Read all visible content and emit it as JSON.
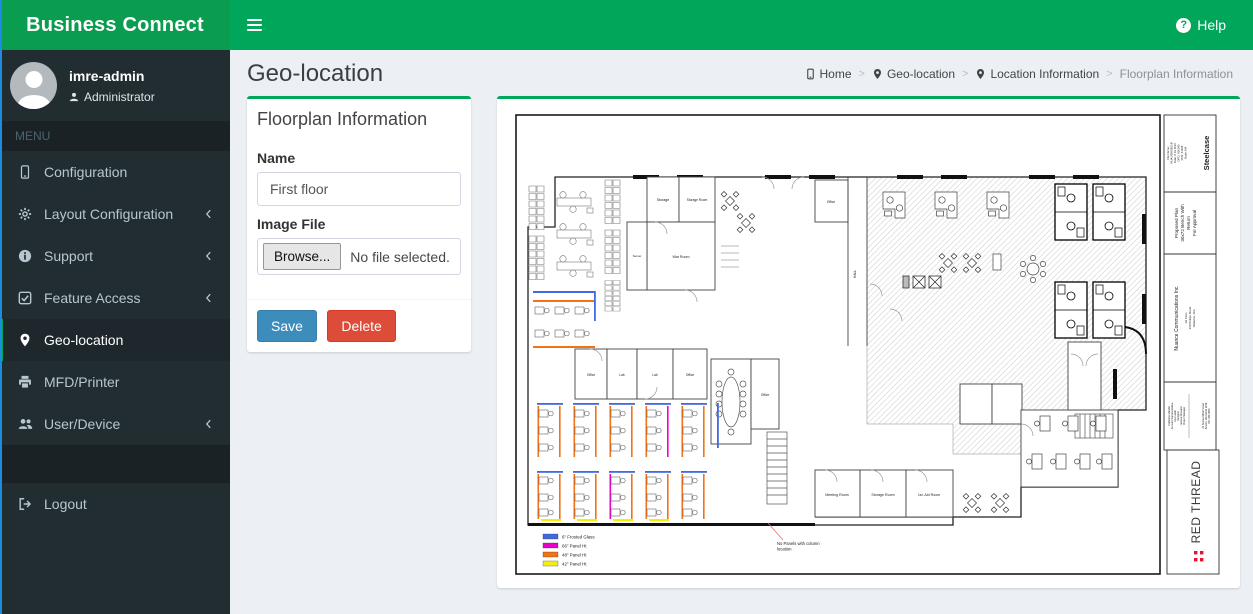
{
  "header": {
    "brand": "Business Connect",
    "help_label": "Help"
  },
  "sidebar": {
    "user": {
      "name": "imre-admin",
      "role": "Administrator"
    },
    "menu_label": "MENU",
    "items": [
      {
        "label": "Configuration"
      },
      {
        "label": "Layout Configuration"
      },
      {
        "label": "Support"
      },
      {
        "label": "Feature Access"
      },
      {
        "label": "Geo-location"
      },
      {
        "label": "MFD/Printer"
      },
      {
        "label": "User/Device"
      }
    ],
    "logout_label": "Logout"
  },
  "content": {
    "page_title": "Geo-location",
    "breadcrumb": [
      {
        "label": "Home"
      },
      {
        "label": "Geo-location"
      },
      {
        "label": "Location Information"
      },
      {
        "label": "Floorplan Information"
      }
    ],
    "form": {
      "panel_title": "Floorplan Information",
      "name_label": "Name",
      "name_value": "First floor",
      "image_label": "Image File",
      "browse_label": "Browse...",
      "file_status": "No file selected.",
      "save_label": "Save",
      "delete_label": "Delete"
    },
    "floorplan": {
      "rooms": {
        "storage": "Storage",
        "storage_room": "Storage Room",
        "war_room": "War Room",
        "server": "Server",
        "office": "Office",
        "lab": "Lab",
        "hall": "HALL",
        "meeting_room": "Meeting Room",
        "storage_room2": "Storage Room",
        "first_aid": "1st. Aid Room"
      },
      "legend": [
        {
          "color": "#4169e1",
          "label": "6\" Frosted Glass"
        },
        {
          "color": "#ee00cc",
          "label": "66\" Panel Ht"
        },
        {
          "color": "#f47216",
          "label": "48\" Panel Ht"
        },
        {
          "color": "#f7ef00",
          "label": "42\" Panel Ht"
        }
      ],
      "annotation": [
        "No Panels with column",
        "location"
      ],
      "title_block": {
        "file_lines": [
          "File Name:",
          "NUA-XBASE01B",
          "Date: 8 19 2016",
          "DPO: 960340",
          "PFN: 61108",
          "Scale: NA"
        ],
        "brand": "Steelcase",
        "plan_lines": [
          "Proposed Plan",
          "30x72 Bench With",
          "Return",
          "For Approval"
        ],
        "client": "Nuance Communications Inc.",
        "client_lines": [
          "1st Floor",
          "460 Philips Street",
          "Waterloo, Ont."
        ],
        "team_lines": [
          "Catherine Mandel",
          "Account Representative",
          "Kira Larkin",
          "Designer",
          "Jessica Girouard",
          "Project Manager"
        ],
        "office_lines": [
          "22 Boston Wharf Road",
          "Boston, MA 02210 1198",
          "617 439 4900"
        ],
        "vendor": "RED THREAD"
      }
    }
  }
}
